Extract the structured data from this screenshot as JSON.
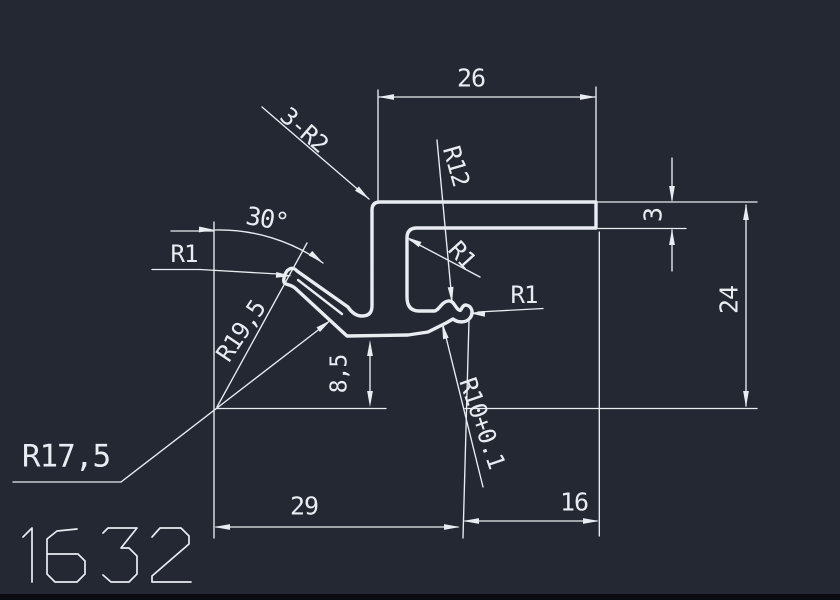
{
  "app": {
    "type": "cad-drawing-viewport",
    "colors": {
      "background": "#232833",
      "line": "#e9edf2",
      "bottom_edge": "#0a0c11"
    }
  },
  "drawing": {
    "number": "1632",
    "dimensions": [
      {
        "id": "dim-26",
        "text": "26"
      },
      {
        "id": "leader-3-r2",
        "text": "3-R2"
      },
      {
        "id": "leader-r12",
        "text": "R12"
      },
      {
        "id": "dim-30deg",
        "text": "30°"
      },
      {
        "id": "leader-r1-hook",
        "text": "R1"
      },
      {
        "id": "leader-r1-web",
        "text": "R1"
      },
      {
        "id": "leader-r1-bead",
        "text": "R1"
      },
      {
        "id": "leader-r19-5",
        "text": "R19,5"
      },
      {
        "id": "dim-8-5",
        "text": "8,5"
      },
      {
        "id": "leader-r17-5",
        "text": "R17,5"
      },
      {
        "id": "leader-r10",
        "text": "R10+0.1"
      },
      {
        "id": "dim-3",
        "text": "3"
      },
      {
        "id": "dim-24",
        "text": "24"
      },
      {
        "id": "dim-29",
        "text": "29"
      },
      {
        "id": "dim-16",
        "text": "16"
      }
    ]
  }
}
